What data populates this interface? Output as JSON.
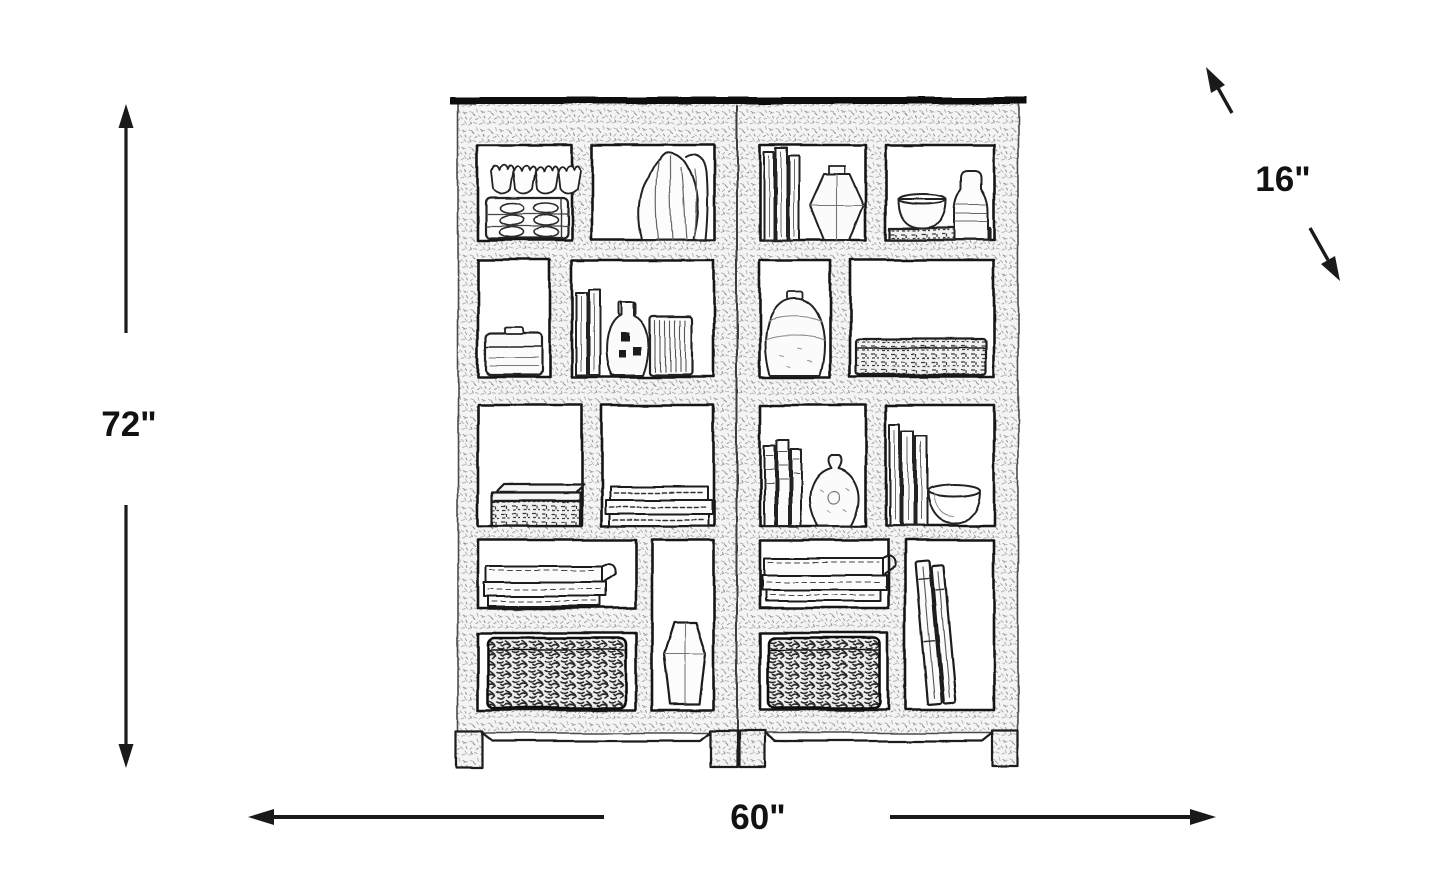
{
  "canvas": {
    "background": "#ffffff",
    "ink": "#1c1c1c"
  },
  "diagram": {
    "type": "furniture dimension sketch",
    "subject": "two-piece open bookcase wall unit with shelf decor",
    "dimensions": {
      "height_label": "72\"",
      "width_label": "60\"",
      "depth_label": "16\""
    },
    "decor_items": [
      "scalloped tray with goblets",
      "draped tall vase",
      "lidded storage box",
      "standing books",
      "pierced bottle vase",
      "ribbed cylinder vase",
      "woven low box",
      "stacked books",
      "faceted geometric vase",
      "bowl with bottle",
      "round jar vase",
      "woven tray",
      "gourd vase",
      "round bowl",
      "flat book stacks",
      "faceted teardrop vase",
      "woven baskets",
      "leaning tall books"
    ]
  }
}
